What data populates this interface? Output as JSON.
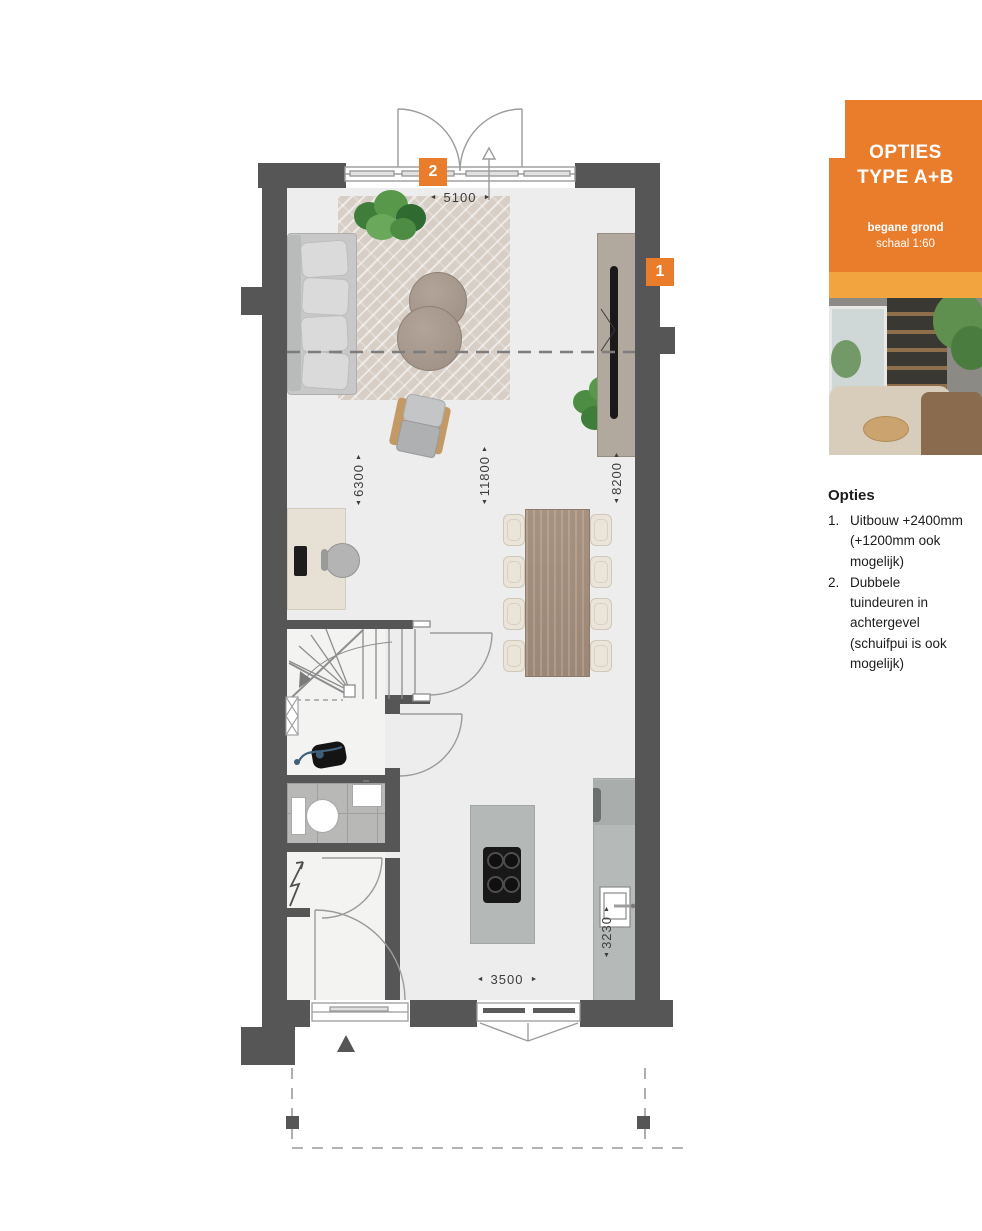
{
  "card": {
    "title_line1": "OPTIES",
    "title_line2": "TYPE A+B",
    "subtitle_bold": "begane grond",
    "subtitle": "schaal 1:60"
  },
  "notes": {
    "heading": "Opties",
    "items": [
      {
        "number": "1.",
        "text": "Uitbouw +2400mm (+1200mm ook mogelijk)"
      },
      {
        "number": "2.",
        "text": "Dubbele tuindeuren in achtergevel (schuifpui is ook mogelijk)"
      }
    ]
  },
  "plan": {
    "markers": [
      {
        "label": "2"
      },
      {
        "label": "1"
      }
    ],
    "dimensions": [
      {
        "text": "5100",
        "orientation": "horizontal"
      },
      {
        "text": "6300",
        "orientation": "vertical"
      },
      {
        "text": "11800",
        "orientation": "vertical"
      },
      {
        "text": "8200",
        "orientation": "vertical"
      },
      {
        "text": "3230",
        "orientation": "vertical"
      },
      {
        "text": "3500",
        "orientation": "horizontal"
      }
    ],
    "arrows": {
      "left": "◄",
      "right": "►",
      "up": "▲",
      "down": "▼"
    }
  },
  "colors": {
    "accent": "#EA7D2C",
    "accent-light": "#F2A43E",
    "wall": "#575656",
    "floor": "#ECEDEC",
    "dim-text": "#3D3D3C"
  }
}
